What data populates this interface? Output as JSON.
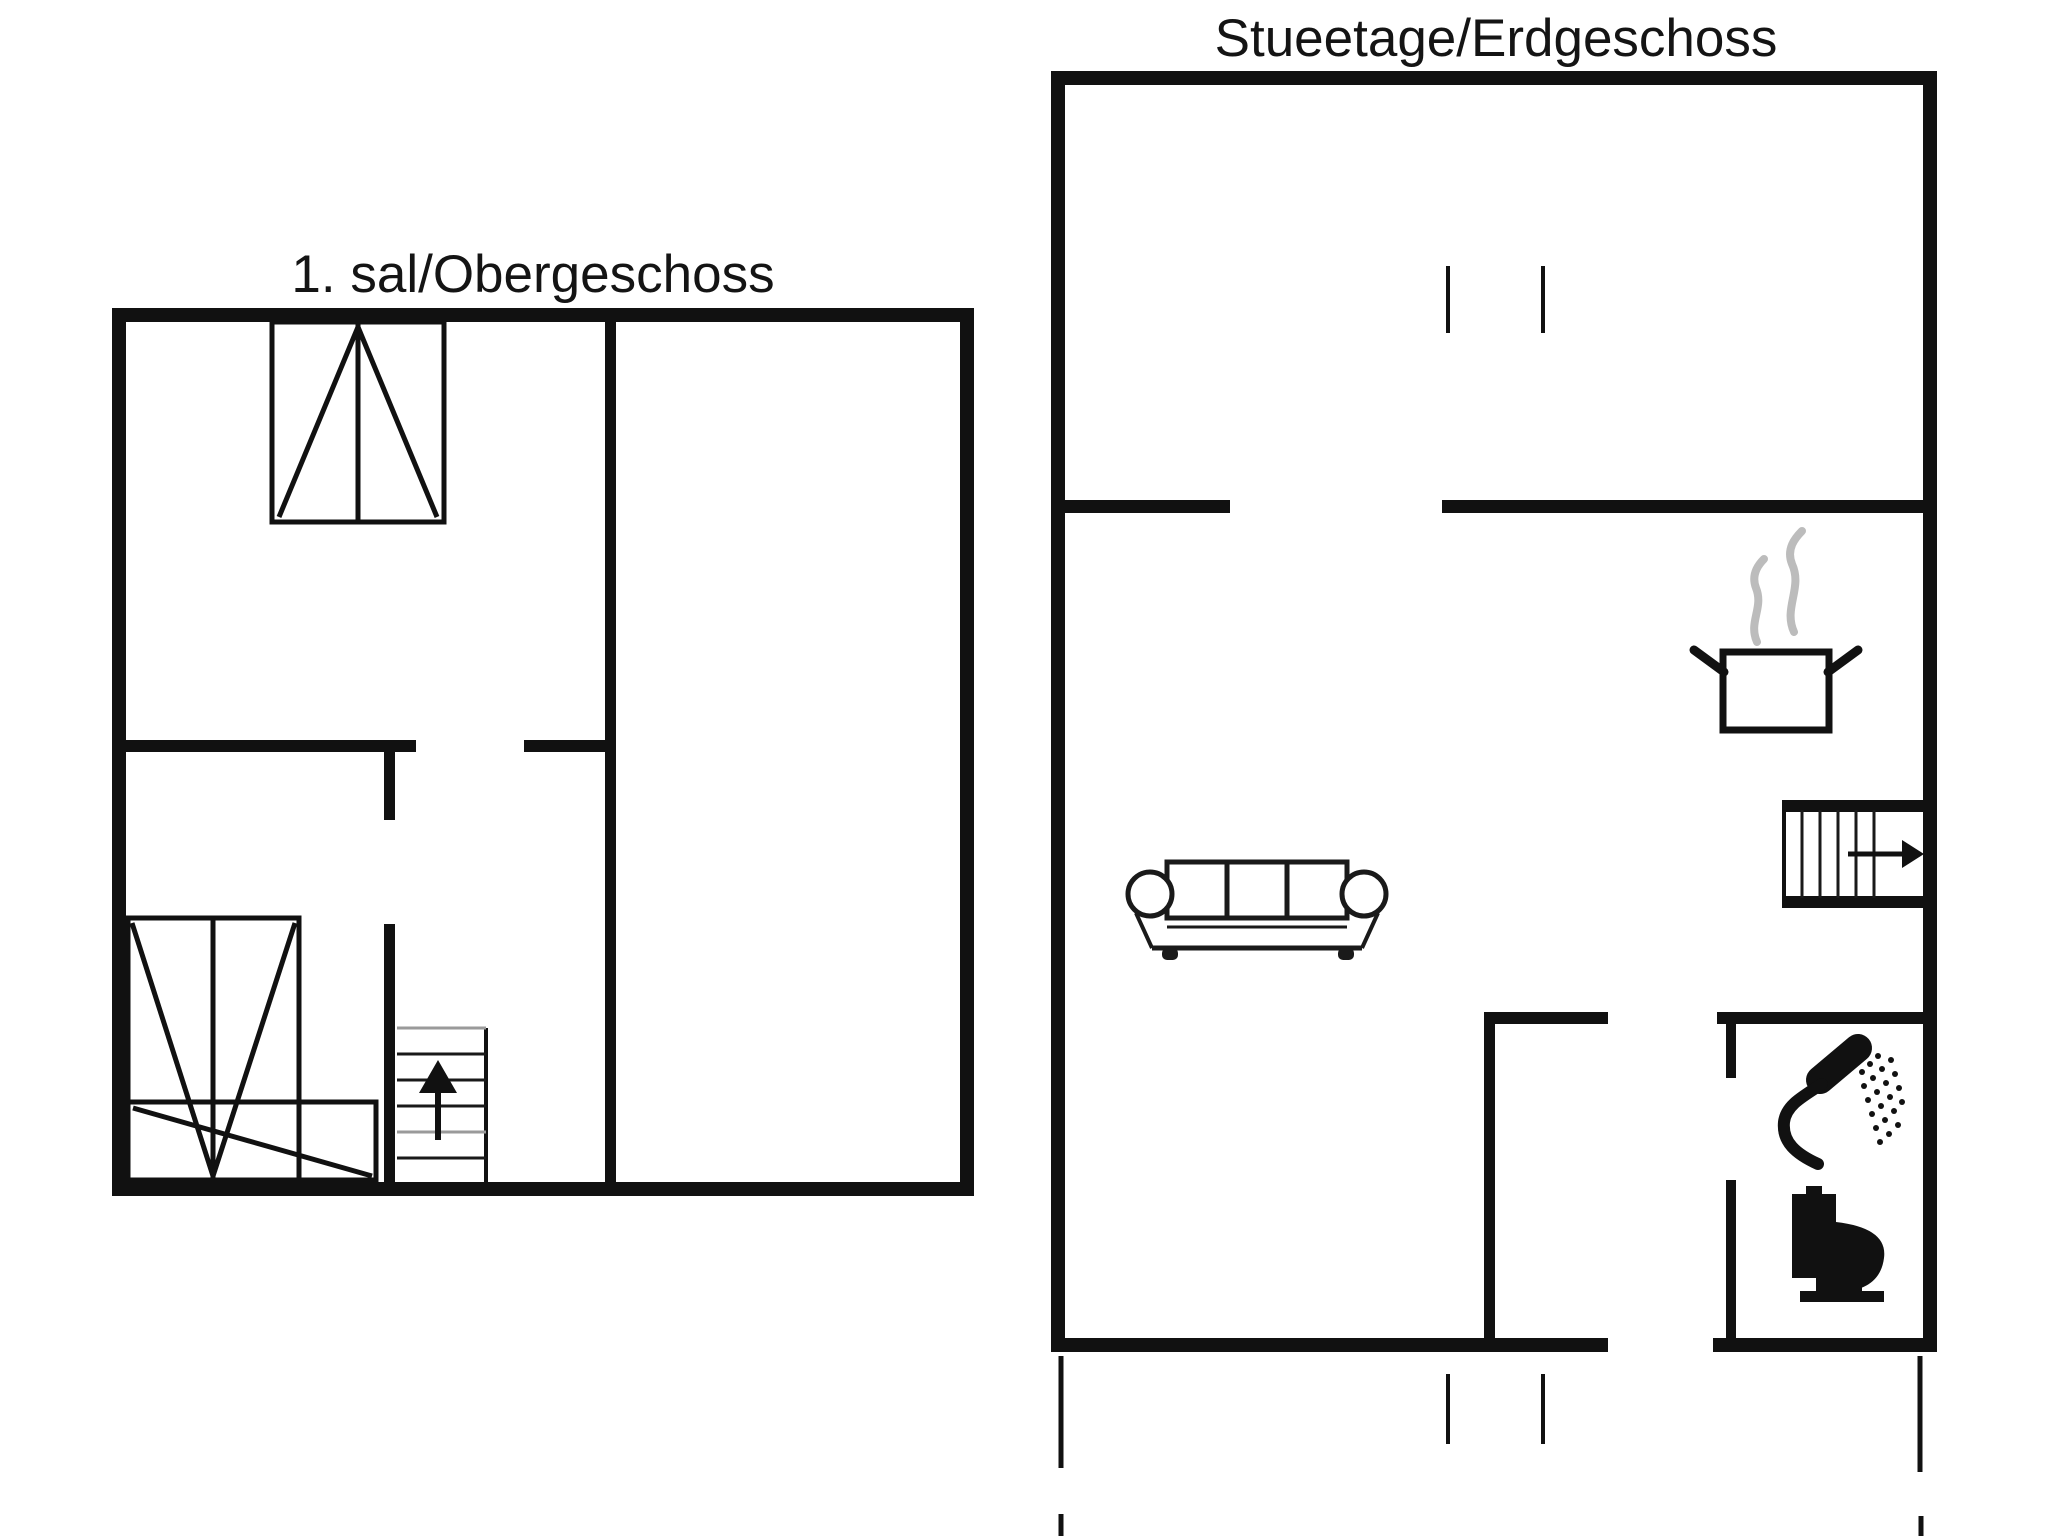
{
  "page": {
    "background_color": "#ffffff",
    "line_color": "#111111",
    "light_tread_color": "#9a9a9a",
    "steam_color": "#bcbcbc"
  },
  "floors": {
    "upper": {
      "title": "1. sal/Obergeschoss",
      "icons": [
        "wardrobe-icon",
        "wardrobe-icon",
        "cabinet-icon",
        "stairs-up-arrow-icon"
      ]
    },
    "ground": {
      "title": "Stueetage/Erdgeschoss",
      "icons": [
        "window-tick-marks",
        "cooking-pot-steam-icon",
        "sofa-icon",
        "stairs-right-arrow-icon",
        "shower-icon",
        "toilet-icon",
        "terrace-outline-marks"
      ]
    }
  }
}
